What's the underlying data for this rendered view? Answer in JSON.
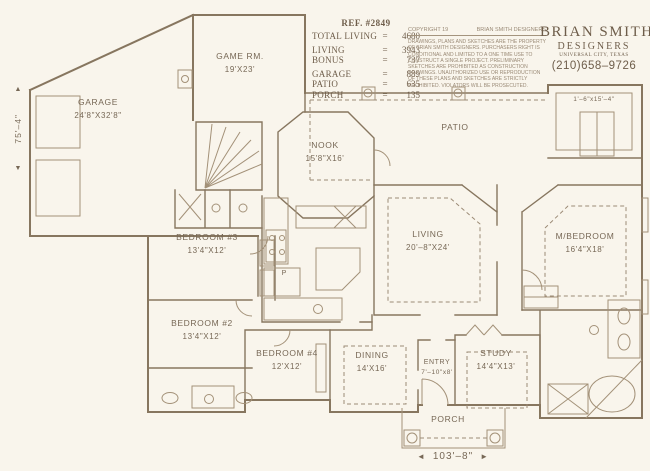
{
  "header": {
    "ref": "REF. #2849",
    "stats": [
      {
        "label": "TOTAL LIVING",
        "eq": "=",
        "value": "4680"
      },
      {
        "label": "LIVING",
        "eq": "=",
        "value": "3943"
      },
      {
        "label": "BONUS",
        "eq": "=",
        "value": "737"
      },
      {
        "label": "GARAGE",
        "eq": "=",
        "value": "889"
      },
      {
        "label": "PATIO",
        "eq": "=",
        "value": "635"
      },
      {
        "label": "PORCH",
        "eq": "=",
        "value": "135"
      }
    ],
    "copyright_left": "COPYRIGHT 19",
    "copyright_right": "BRIAN SMITH DESIGNERS",
    "copyright_body": "DRAWINGS, PLANS AND SKETCHES ARE THE PROPERTY OF BRIAN SMITH DESIGNERS.  PURCHASERS RIGHT IS CONDITIONAL AND LIMITED TO A ONE TIME USE TO CONSTRUCT A SINGLE PROJECT.  PRELIMINARY SKETCHES ARE PROHIBITED AS CONSTRUCTION DRAWINGS.  UNAUTHORIZED USE OR REPRODUCTION OF THESE PLANS AND SKETCHES ARE STRICTLY PROHIBITED.  VIOLATORS WILL BE PROSECUTED.",
    "firm_name": "BRIAN  SMITH",
    "firm_subtitle": "DESIGNERS",
    "firm_city": "UNIVERSAL CITY, TEXAS",
    "firm_phone": "(210)658–9726"
  },
  "rooms": {
    "garage": {
      "name": "GARAGE",
      "size": "24'8\"X32'8\""
    },
    "game": {
      "name": "GAME RM.",
      "size": "19'X23'"
    },
    "nook": {
      "name": "NOOK",
      "size": "15'8\"X16'"
    },
    "patio": {
      "name": "PATIO",
      "size": ""
    },
    "living": {
      "name": "LIVING",
      "size": "20'–8\"X24'"
    },
    "master": {
      "name": "M/BEDROOM",
      "size": "16'4\"X18'"
    },
    "bed3": {
      "name": "BEDROOM #3",
      "size": "13'4\"X12'"
    },
    "bed2": {
      "name": "BEDROOM #2",
      "size": "13'4\"X12'"
    },
    "bed4": {
      "name": "BEDROOM #4",
      "size": "12'X12'"
    },
    "dining": {
      "name": "DINING",
      "size": "14'X16'"
    },
    "entry": {
      "name": "ENTRY",
      "size": "7'–10\"x8'"
    },
    "study": {
      "name": "STUDY",
      "size": "14'4\"X13'"
    },
    "porch": {
      "name": "PORCH",
      "size": ""
    },
    "toproom": {
      "name": "",
      "size": "1'–6\"x15'–4\""
    }
  },
  "annotations": {
    "left_dim": "75'–4\"",
    "bottom_dim": "103'–8\"",
    "pantry": "P",
    "arrow_up": "▲",
    "arrow_down": "▼",
    "arrow_left": "◄",
    "arrow_right": "►"
  },
  "colors": {
    "paper": "#f9f5ec",
    "wall_ink": "#87765f",
    "light_ink": "#a39178",
    "label_ink": "#776856"
  }
}
